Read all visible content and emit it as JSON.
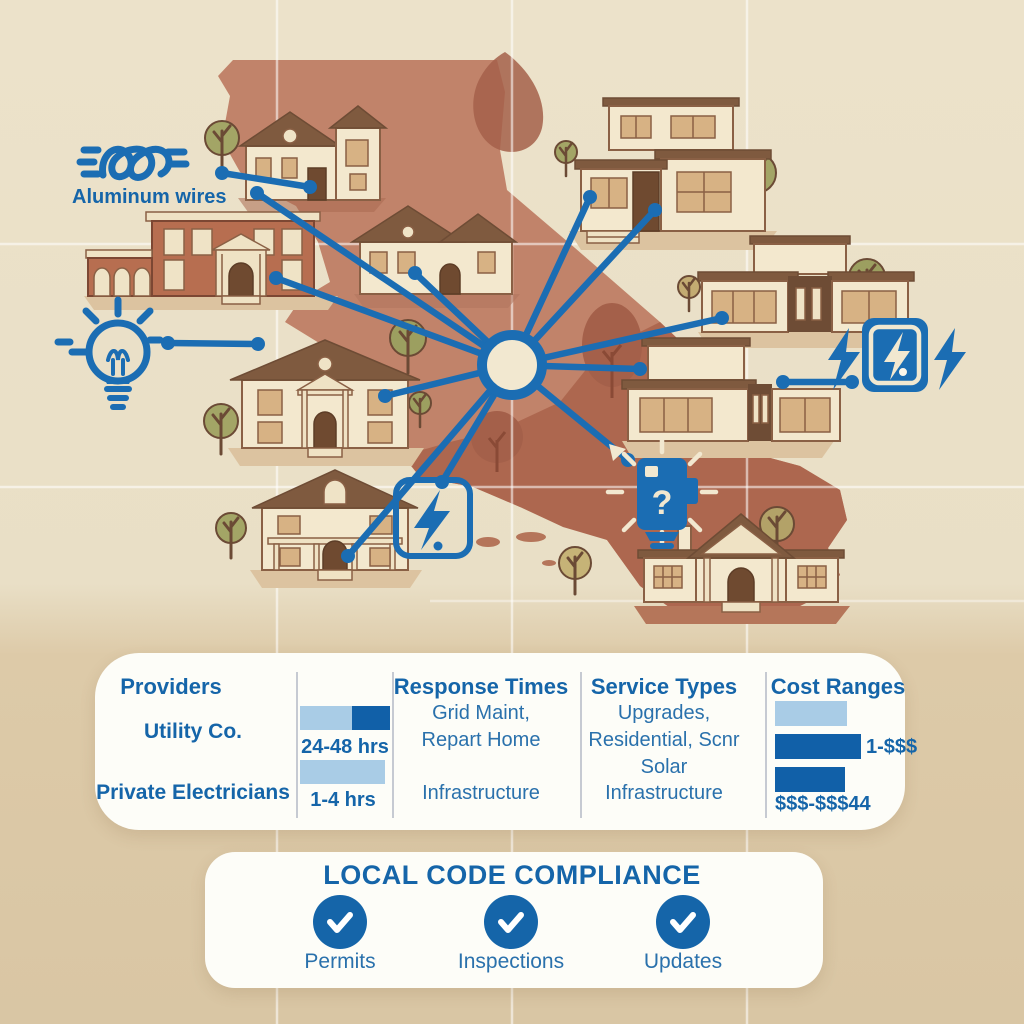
{
  "colors": {
    "accent_blue": "#1b6db3",
    "text_blue": "#1565a9",
    "bar_light": "#a9cce6",
    "bar_dark": "#1160a8",
    "map_terracotta": "#c1836a",
    "map_terracotta_dark": "#ad674f",
    "background_top": "#e9dfc6",
    "background_bottom": "#d9c6a4",
    "card": "#fdfdf8"
  },
  "map": {
    "aluminum_wires_label": "Aluminum wires",
    "meter_glyph": "?",
    "icons": [
      "aluminum-wires-icon",
      "lightbulb-icon",
      "lightning-bolt-square-icon",
      "smart-meter-question-icon",
      "electric-panel-bolts-icon"
    ],
    "houses": [
      "victorian-mansion",
      "brick-townhouse",
      "gable-house",
      "modern-two-story",
      "modern-ranch",
      "colonial-house",
      "modern-flat-roof",
      "farmhouse",
      "bungalow"
    ]
  },
  "table": {
    "headers": [
      "Providers",
      "Response Times",
      "Service Types",
      "Cost Ranges"
    ],
    "rows": [
      {
        "provider": "Utility Co.",
        "time": "24-48 hrs",
        "response": "Grid Maint,\nRepart Home",
        "service": "Upgrades,\nResidential, Scnr\nSolar",
        "cost": "1-$$$"
      },
      {
        "provider": "Private Electricians",
        "time": "1-4 hrs",
        "response": "Infrastructure",
        "service": "Infrastructure",
        "cost": "$$$-$$$44"
      }
    ],
    "time_bars": [
      {
        "segments": [
          {
            "tone": "light",
            "width": 52
          },
          {
            "tone": "dark",
            "width": 38
          }
        ]
      },
      {
        "segments": [
          {
            "tone": "light",
            "width": 85
          }
        ]
      }
    ],
    "cost_bars": [
      {
        "tone": "light",
        "width": 72
      },
      {
        "tone": "dark",
        "width": 86
      },
      {
        "tone": "dark",
        "width": 70
      }
    ]
  },
  "compliance": {
    "title": "LOCAL CODE COMPLIANCE",
    "items": [
      {
        "label": "Permits"
      },
      {
        "label": "Inspections"
      },
      {
        "label": "Updates"
      }
    ]
  }
}
